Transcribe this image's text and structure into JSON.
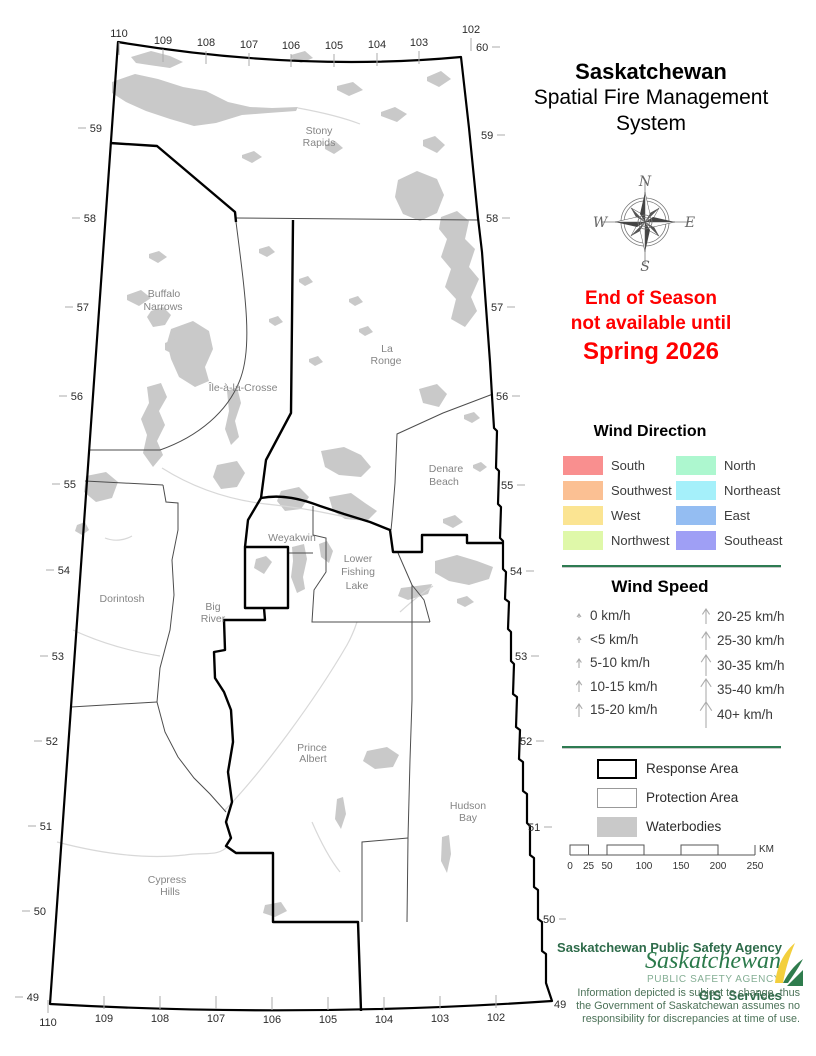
{
  "title": {
    "line1": "Saskatchewan",
    "line2": "Spatial Fire Management",
    "line3": "System"
  },
  "notice": {
    "line1": "End of Season",
    "line2": "not available until",
    "line3": "Spring 2026",
    "color": "#FF0000"
  },
  "compass": {
    "n": "N",
    "e": "E",
    "s": "S",
    "w": "W"
  },
  "wind_direction": {
    "title": "Wind Direction",
    "items": [
      {
        "label": "South",
        "color": "#F98F8F"
      },
      {
        "label": "Southwest",
        "color": "#FBC093"
      },
      {
        "label": "West",
        "color": "#FBE492"
      },
      {
        "label": "Northwest",
        "color": "#DFF8A9"
      },
      {
        "label": "North",
        "color": "#ADF7CF"
      },
      {
        "label": "Northeast",
        "color": "#A5F0FA"
      },
      {
        "label": "East",
        "color": "#94BDF2"
      },
      {
        "label": "Southeast",
        "color": "#9F9FF5"
      }
    ]
  },
  "wind_speed": {
    "title": "Wind Speed",
    "items": [
      {
        "label": "0 km/h",
        "size": 7
      },
      {
        "label": "<5 km/h",
        "size": 9
      },
      {
        "label": "5-10 km/h",
        "size": 12
      },
      {
        "label": "10-15 km/h",
        "size": 14
      },
      {
        "label": "15-20 km/h",
        "size": 16
      },
      {
        "label": "20-25 km/h",
        "size": 18
      },
      {
        "label": "25-30 km/h",
        "size": 21
      },
      {
        "label": "30-35 km/h",
        "size": 24
      },
      {
        "label": "35-40 km/h",
        "size": 26
      },
      {
        "label": "40+ km/h",
        "size": 29
      }
    ]
  },
  "legend": {
    "items": [
      {
        "label": "Response Area"
      },
      {
        "label": "Protection Area"
      },
      {
        "label": "Waterbodies",
        "color": "#C9C9C9"
      }
    ]
  },
  "scale_bar": {
    "ticks": [
      "0",
      "25",
      "50",
      "100",
      "150",
      "200",
      "250"
    ],
    "unit": "KM"
  },
  "credits": {
    "line1": "Saskatchewan Public Safety Agency",
    "line2": "GIS  Services"
  },
  "logo": {
    "name": "Saskatchewan",
    "subtitle": "PUBLIC SAFETY AGENCY"
  },
  "disclaimer": {
    "line1": "Information depicted is subject to change, thus",
    "line2": "the Government of Saskatchewan assumes no",
    "line3": "responsibility for discrepancies at time of use."
  },
  "map": {
    "place_labels": [
      {
        "text": "Stony",
        "x": 319,
        "y": 134
      },
      {
        "text": "Rapids",
        "x": 319,
        "y": 146
      },
      {
        "text": "Buffalo",
        "x": 164,
        "y": 297
      },
      {
        "text": "Narrows",
        "x": 163,
        "y": 310
      },
      {
        "text": "Île-à-la-Crosse",
        "x": 243,
        "y": 391
      },
      {
        "text": "La",
        "x": 387,
        "y": 352
      },
      {
        "text": "Ronge",
        "x": 386,
        "y": 364
      },
      {
        "text": "Denare",
        "x": 446,
        "y": 472
      },
      {
        "text": "Beach",
        "x": 444,
        "y": 485
      },
      {
        "text": "Weyakwin",
        "x": 292,
        "y": 541
      },
      {
        "text": "Lower",
        "x": 358,
        "y": 562
      },
      {
        "text": "Fishing",
        "x": 358,
        "y": 575
      },
      {
        "text": "Lake",
        "x": 357,
        "y": 589
      },
      {
        "text": "Dorintosh",
        "x": 122,
        "y": 602
      },
      {
        "text": "Big",
        "x": 213,
        "y": 610
      },
      {
        "text": "River",
        "x": 213,
        "y": 622
      },
      {
        "text": "Prince",
        "x": 312,
        "y": 751
      },
      {
        "text": "Albert",
        "x": 313,
        "y": 762
      },
      {
        "text": "Hudson",
        "x": 468,
        "y": 809
      },
      {
        "text": "Bay",
        "x": 468,
        "y": 821
      },
      {
        "text": "Cypress",
        "x": 167,
        "y": 883
      },
      {
        "text": "Hills",
        "x": 170,
        "y": 895
      }
    ],
    "lat_left": [
      {
        "t": "59",
        "x": 102,
        "y": 132
      },
      {
        "t": "58",
        "x": 96,
        "y": 222
      },
      {
        "t": "57",
        "x": 89,
        "y": 311
      },
      {
        "t": "56",
        "x": 83,
        "y": 400
      },
      {
        "t": "55",
        "x": 76,
        "y": 488
      },
      {
        "t": "54",
        "x": 70,
        "y": 574
      },
      {
        "t": "53",
        "x": 64,
        "y": 660
      },
      {
        "t": "52",
        "x": 58,
        "y": 745
      },
      {
        "t": "51",
        "x": 52,
        "y": 830
      },
      {
        "t": "50",
        "x": 46,
        "y": 915
      },
      {
        "t": "49",
        "x": 39,
        "y": 1001
      }
    ],
    "lat_right": [
      {
        "t": "60",
        "x": 476,
        "y": 51
      },
      {
        "t": "59",
        "x": 481,
        "y": 139
      },
      {
        "t": "58",
        "x": 486,
        "y": 222
      },
      {
        "t": "57",
        "x": 491,
        "y": 311
      },
      {
        "t": "56",
        "x": 496,
        "y": 400
      },
      {
        "t": "55",
        "x": 501,
        "y": 489
      },
      {
        "t": "54",
        "x": 510,
        "y": 575
      },
      {
        "t": "53",
        "x": 515,
        "y": 660
      },
      {
        "t": "52",
        "x": 520,
        "y": 745
      },
      {
        "t": "51",
        "x": 528,
        "y": 831
      },
      {
        "t": "50",
        "x": 543,
        "y": 923
      },
      {
        "t": "49",
        "x": 554,
        "y": 1008
      }
    ],
    "lon_top": [
      {
        "t": "110",
        "x": 119,
        "y": 37
      },
      {
        "t": "109",
        "x": 163,
        "y": 44
      },
      {
        "t": "108",
        "x": 206,
        "y": 46
      },
      {
        "t": "107",
        "x": 249,
        "y": 48
      },
      {
        "t": "106",
        "x": 291,
        "y": 49
      },
      {
        "t": "105",
        "x": 334,
        "y": 49
      },
      {
        "t": "104",
        "x": 377,
        "y": 48
      },
      {
        "t": "103",
        "x": 419,
        "y": 46
      },
      {
        "t": "102",
        "x": 471,
        "y": 33
      }
    ],
    "lon_bottom": [
      {
        "t": "110",
        "x": 48,
        "y": 1026
      },
      {
        "t": "109",
        "x": 104,
        "y": 1022
      },
      {
        "t": "108",
        "x": 160,
        "y": 1022
      },
      {
        "t": "107",
        "x": 216,
        "y": 1022
      },
      {
        "t": "106",
        "x": 272,
        "y": 1023
      },
      {
        "t": "105",
        "x": 328,
        "y": 1023
      },
      {
        "t": "104",
        "x": 384,
        "y": 1023
      },
      {
        "t": "103",
        "x": 440,
        "y": 1022
      },
      {
        "t": "102",
        "x": 496,
        "y": 1021
      }
    ]
  }
}
